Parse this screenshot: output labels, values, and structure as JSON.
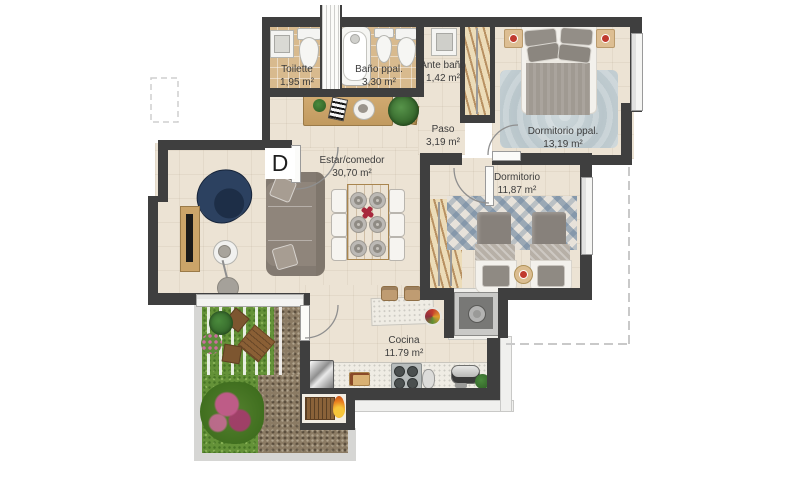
{
  "floorplan": {
    "unit_label": "D",
    "rooms": [
      {
        "name": "Toilette",
        "area": "1,95 m²"
      },
      {
        "name": "Baño ppal.",
        "area": "3,30 m²"
      },
      {
        "name": "Ante baño",
        "area": "1,42 m²"
      },
      {
        "name": "Dormitorio ppal.",
        "area": "13,19 m²"
      },
      {
        "name": "Paso",
        "area": "3,19 m²"
      },
      {
        "name": "Estar/comedor",
        "area": "30,70 m²"
      },
      {
        "name": "Dormitorio",
        "area": "11,87 m²"
      },
      {
        "name": "Cocina",
        "area": "11.79 m²"
      }
    ],
    "colors": {
      "wall": "#3f3f3f",
      "floor_tile": "#ece3d4",
      "bath_tile": "#d8ba8e",
      "grass": "#649238",
      "gravel": "#8b7b64",
      "rug": "#c2cdd2",
      "wood": "#c9a36a",
      "label_text": "#3c3c3c"
    }
  }
}
